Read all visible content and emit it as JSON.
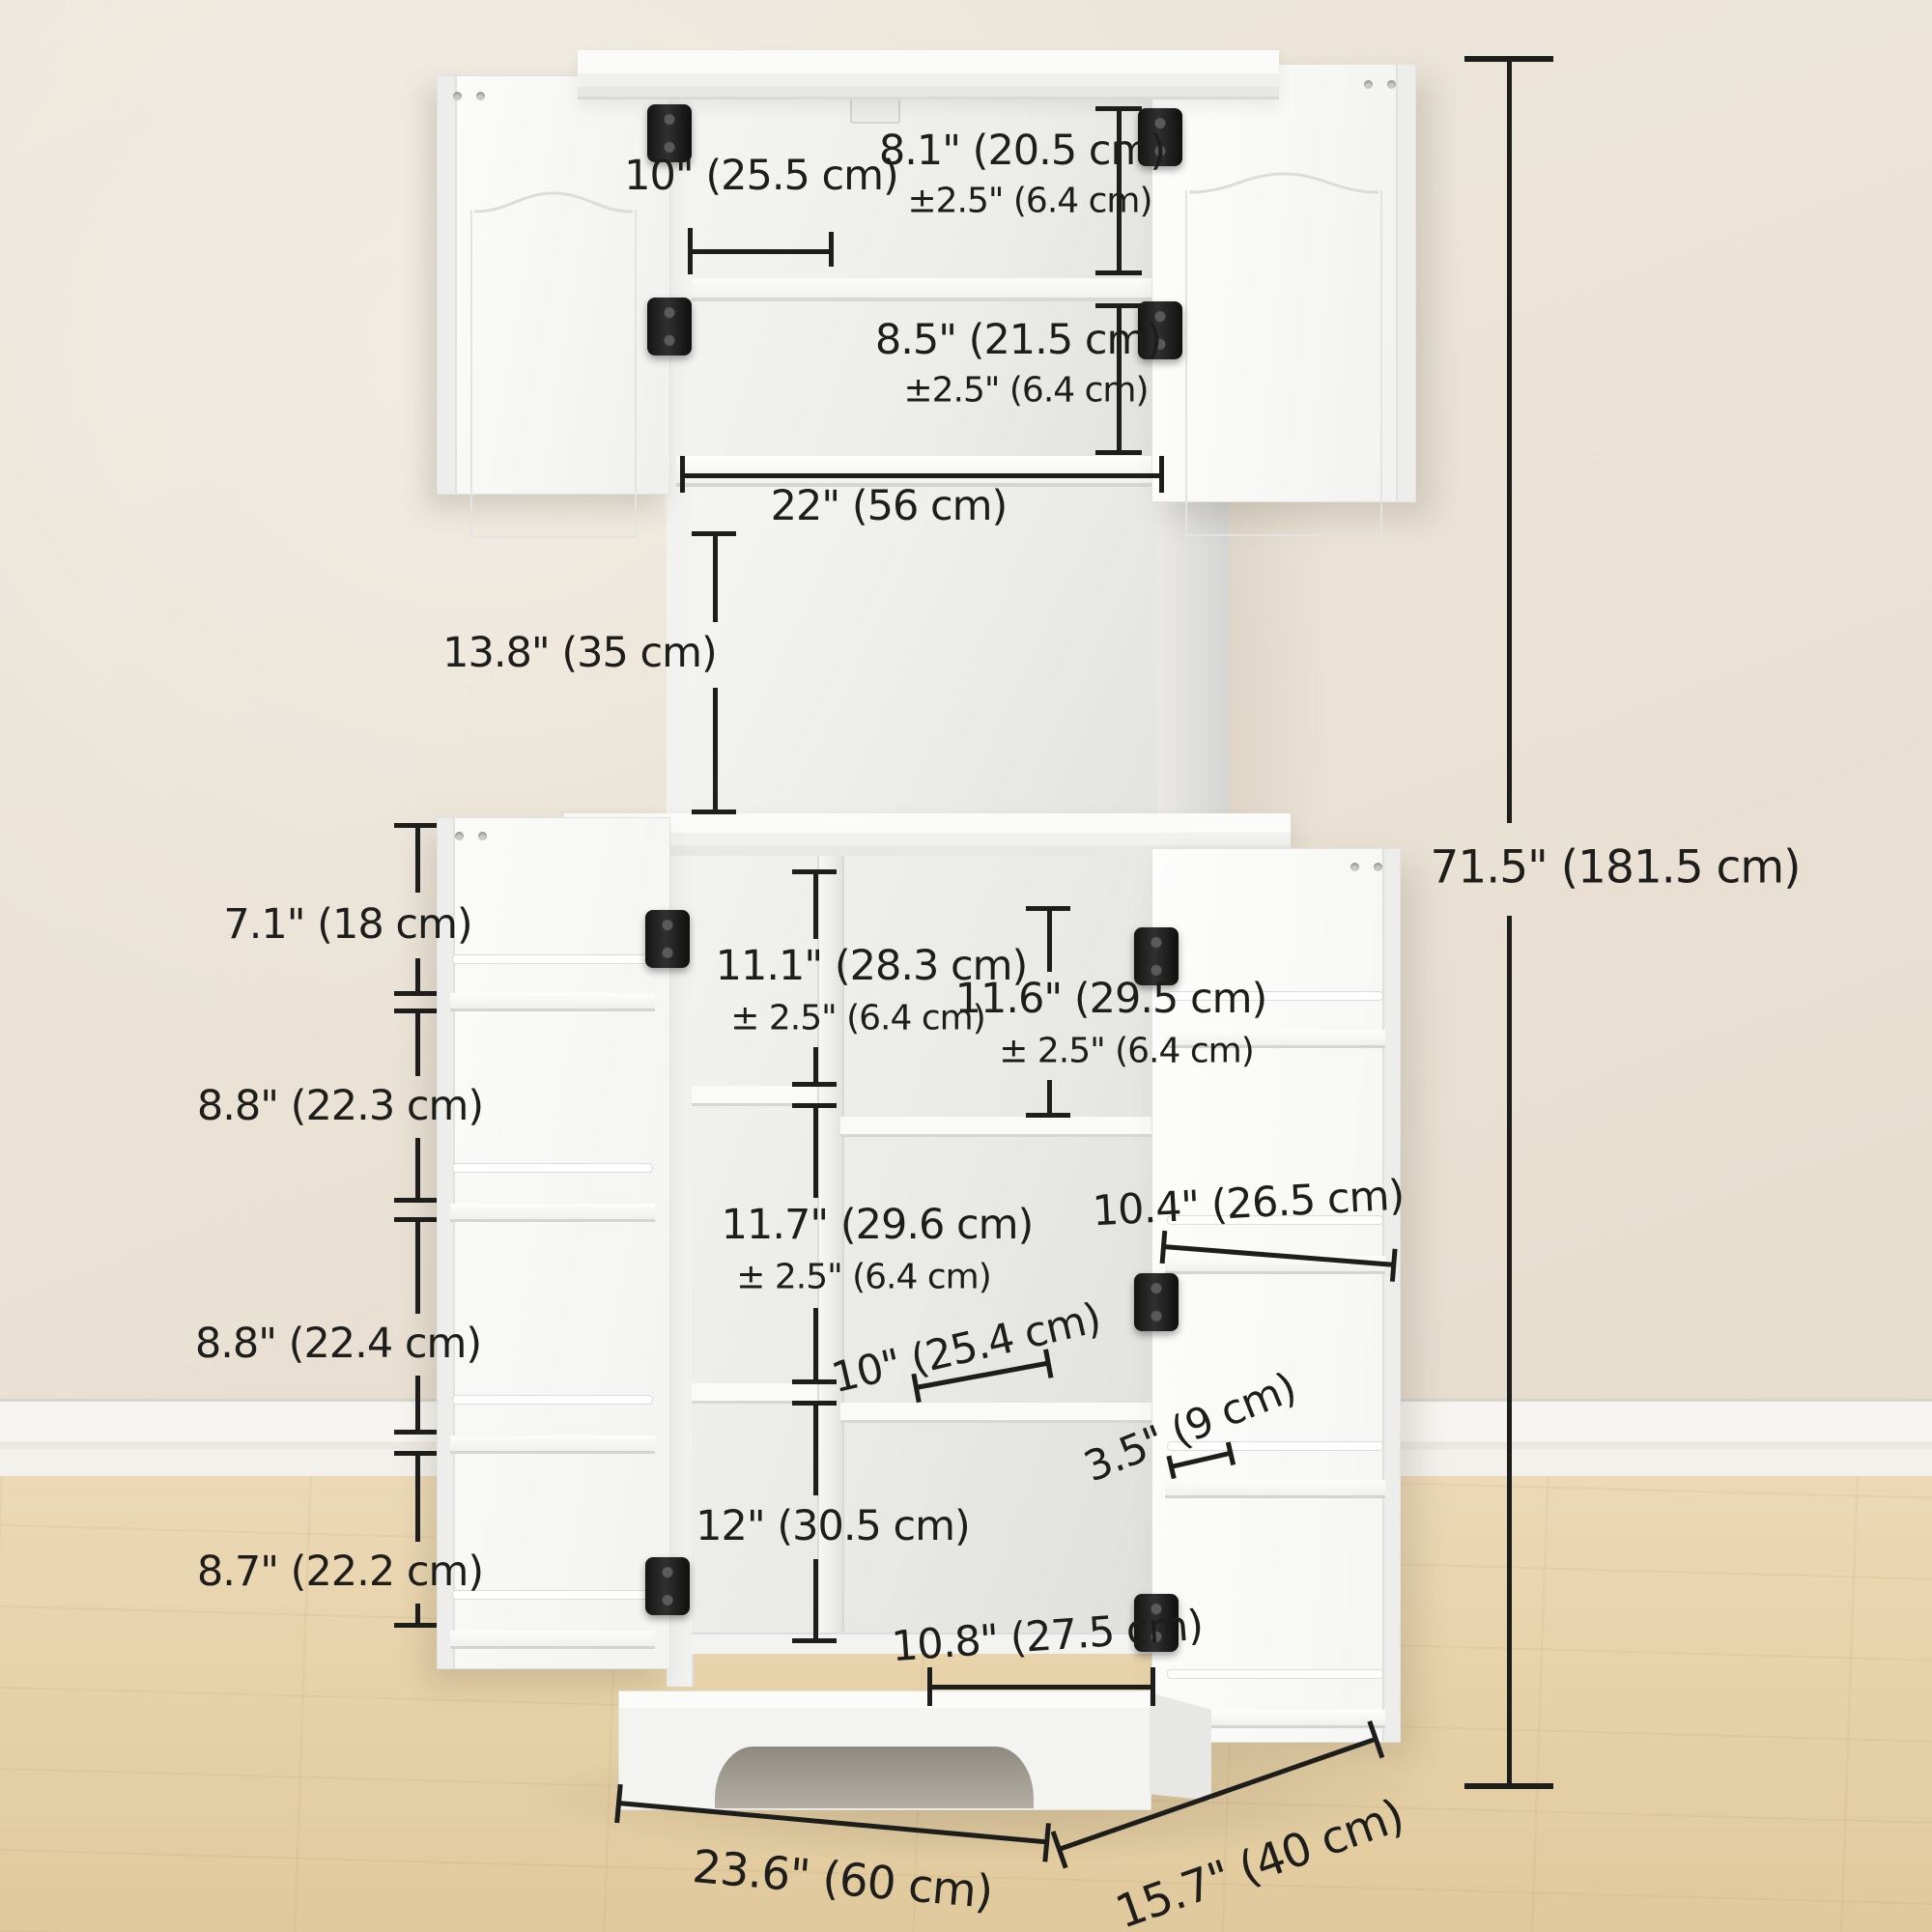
{
  "scene": {
    "wall_color": "#eae2d5",
    "baseboard_color": "#f4f2ed",
    "floor_color": "#e8d4ab",
    "cabinet_color": "#f6f6f4",
    "hinge_color": "#1c1c1c",
    "annotation_color": "#1d1d1b"
  },
  "dimensions": {
    "overall_height": "71.5\" (181.5 cm)",
    "top_cabinet": {
      "shelf_depth": "10\" (25.5 cm)",
      "upper_compartment_height": "8.1\" (20.5 cm)",
      "upper_compartment_tolerance": "±2.5\" (6.4 cm)",
      "lower_compartment_height": "8.5\" (21.5 cm)",
      "lower_compartment_tolerance": "±2.5\" (6.4 cm)",
      "interior_width": "22\" (56 cm)"
    },
    "open_shelf_height": "13.8\" (35 cm)",
    "left_door_rack": {
      "tier1_height": "7.1\" (18 cm)",
      "tier2_height": "8.8\" (22.3 cm)",
      "tier3_height": "8.8\" (22.4 cm)",
      "tier4_height": "8.7\" (22.2 cm)"
    },
    "right_door_rack": {
      "shelf_width": "10.4\" (26.5 cm)",
      "shelf_depth": "3.5\" (9 cm)"
    },
    "lower_cabinet": {
      "left_upper_compartment_height": "11.1\" (28.3 cm)",
      "left_upper_compartment_tolerance": "± 2.5\" (6.4 cm)",
      "right_upper_compartment_height": "11.6\" (29.5 cm)",
      "right_upper_compartment_tolerance": "± 2.5\" (6.4 cm)",
      "left_middle_compartment_height": "11.7\" (29.6 cm)",
      "left_middle_compartment_tolerance": "± 2.5\" (6.4 cm)",
      "shelf_depth": "10\" (25.4 cm)",
      "bottom_compartment_height": "12\" (30.5 cm)",
      "bottom_compartment_width": "10.8\" (27.5 cm)"
    },
    "base": {
      "width": "23.6\" (60 cm)",
      "depth": "15.7\" (40 cm)"
    }
  }
}
